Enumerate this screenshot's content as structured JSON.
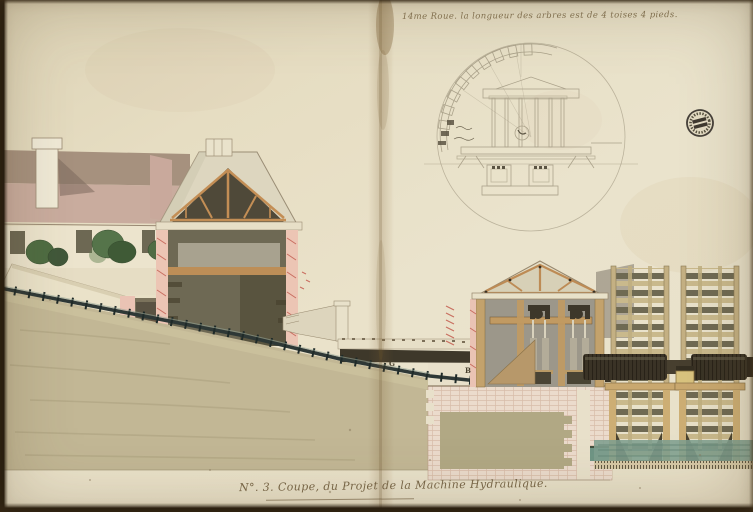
{
  "artwork": {
    "top_annotation": "14me Roue. la longueur des arbres est de 4 toises 4 pieds.",
    "caption": "N°. 3. Coupe, du Projet de la Machine Hydraulique.",
    "labels": {
      "pipe_g": "G",
      "pipe_b": "B"
    },
    "subject_elements": [
      "left-wing-building-with-chimney",
      "sectioned-pavilion-with-roof-truss",
      "garden-wall-and-shrubs",
      "hillside-with-descending-conduit-pipe",
      "aqueduct-head-structure",
      "pump-house-section-with-pump-gear",
      "two-waterwheels-with-axle-drums",
      "masonry-foundation",
      "waterwheel-cross-section-pencil-diagram",
      "circular-collection-stamp",
      "center-fold-crease"
    ],
    "palette": {
      "paper": "#e9e1c9",
      "ink": "#6d5a3b",
      "pencil": "#a59c85",
      "masonry_pink": "#ecc5b4",
      "hatch_red": "#c96e60",
      "wood_tan": "#c38e55",
      "terrain_olive": "#c2b795",
      "interior_dark": "#6e6954",
      "water_teal": "#7f9f90",
      "axle_dark": "#3a3326",
      "roof_mauve": "#c9ac9e"
    }
  }
}
